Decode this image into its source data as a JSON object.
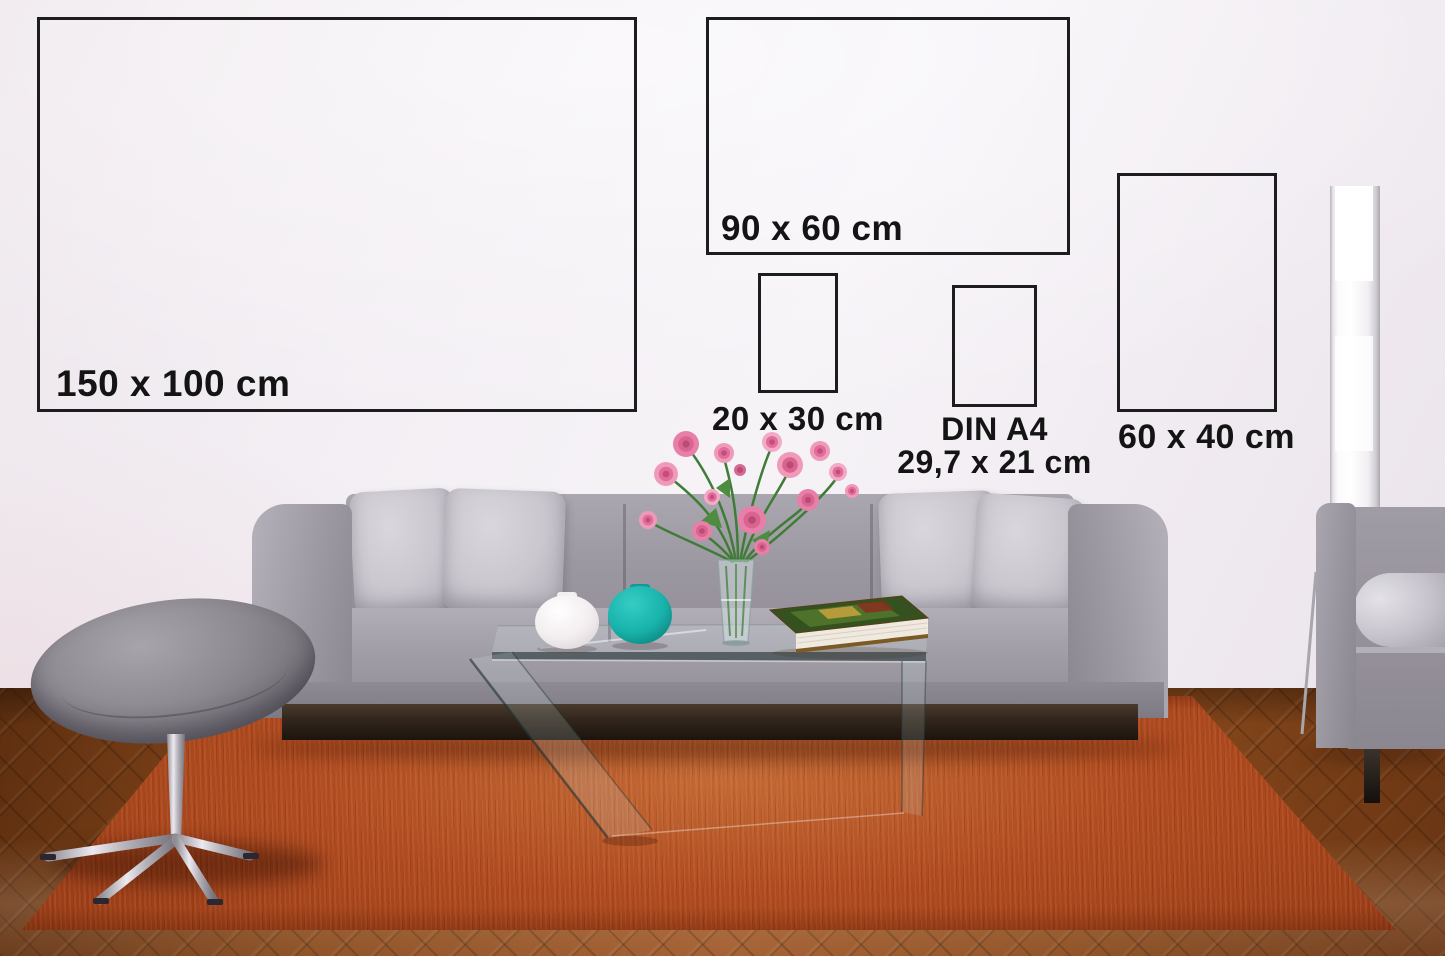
{
  "overlay": {
    "border_color": "#1d1d1d",
    "text_color": "#141414",
    "boxes": [
      {
        "id": "150x100",
        "label": "150 x 100 cm"
      },
      {
        "id": "90x60",
        "label": "90 x 60 cm"
      },
      {
        "id": "20x30",
        "label": "20 x 30 cm"
      },
      {
        "id": "din-a4",
        "label": "DIN A4",
        "sublabel": "29,7 x 21 cm"
      },
      {
        "id": "60x40",
        "label": "60 x 40 cm"
      }
    ]
  },
  "palette": {
    "wall": "#f1edf2",
    "overlay_border": "#1d1d1d",
    "overlay_text": "#141414",
    "wood": "#8a4a1c",
    "wood_dark": "#5e2f10",
    "wood_light": "#a0592a",
    "rug": "#b04a1f",
    "rug_dark": "#7d2f10",
    "rug_light": "#c46a35",
    "sofa": "#9d99a3",
    "sofa_light": "#b5b1bb",
    "sofa_dark": "#7e7a84",
    "cushion": "#cac7cf",
    "plinth": "#33271d",
    "stool": "#8e8b93",
    "chrome": "#d2cfd6",
    "vase_teal": "#17b3ab",
    "vase_white": "#f7f4f7",
    "flower_pink": "#ef9ab9",
    "flower_deep": "#d8648f",
    "leaf_green": "#437c36",
    "book_cover": "#35511f",
    "book_pages": "#efe9df",
    "lamp_white": "#ffffff",
    "lamp_edge": "#b6b3ba"
  }
}
